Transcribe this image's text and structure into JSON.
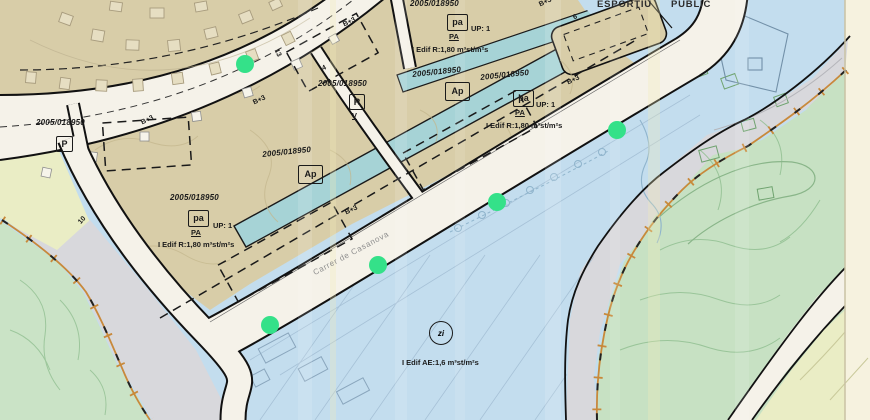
{
  "map": {
    "parcel_ref": "2005/018950",
    "zone_codes": {
      "pa": "pa",
      "pa_sub": "PA",
      "ap": "Ap",
      "p": "P",
      "r": "R",
      "v": "V",
      "zi": "zi"
    },
    "planning": {
      "up": "UP: 1",
      "edif_r": "I Edif R:1,80 m³st/m²s",
      "edif_ae": "I Edif AE:1,6 m³st/m²s",
      "height": "B+3"
    },
    "area_labels": {
      "esportiu": "ESPORTIU",
      "public": "PUBLIC"
    },
    "street": {
      "name": "Carrer de Casanova"
    },
    "dimensions": {
      "d10": "10",
      "d13": "13",
      "d4": "4",
      "d6": "6"
    }
  },
  "markers": {
    "count": 5
  },
  "colors": {
    "margin": "#f6f2df",
    "tan": "#d8cda8",
    "blue": "#c3ddee",
    "teal": "#a6d3d6",
    "green_left": "#cae3c6",
    "green_right": "#c7e1c3",
    "yellow": "#eaedc5",
    "road": "#f5f2e9",
    "gray": "#d8d8dc",
    "orange": "#c8893b",
    "ink": "#1a1a1a",
    "marker": "#34e189",
    "contour_tan": "#c3b68c",
    "contour_green": "#92c092",
    "parcel_blue": "#9db8cf",
    "street_text": "#8e8e8e"
  }
}
